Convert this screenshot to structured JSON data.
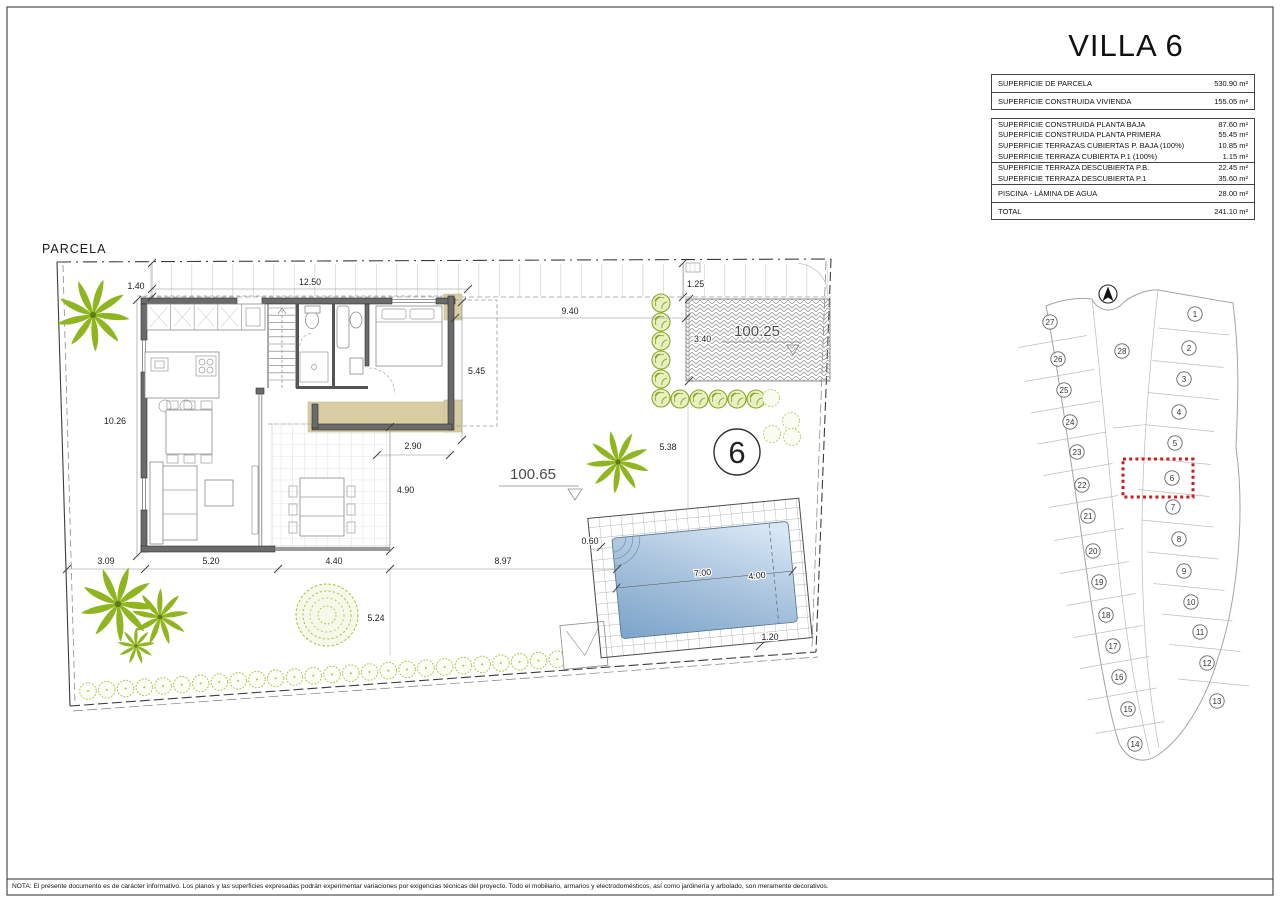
{
  "title": "VILLA 6",
  "areas_table": {
    "sections": [
      {
        "rows": [
          {
            "label": "SUPERFICIE DE PARCELA",
            "value": "530.90 m²"
          }
        ]
      },
      {
        "rows": [
          {
            "label": "SUPERFICIE CONSTRUIDA VIVIENDA",
            "value": "155.05 m²"
          }
        ]
      },
      {
        "rows": [
          {
            "label": "SUPERFICIE CONSTRUIDA PLANTA BAJA",
            "value": "87.60 m²"
          },
          {
            "label": "SUPERFICIE CONSTRUIDA PLANTA PRIMERA",
            "value": "55.45 m²"
          },
          {
            "label": "SUPERFICIE TERRAZAS CUBIERTAS P. BAJA (100%)",
            "value": "10.85 m²"
          },
          {
            "label": "SUPERFICIE TERRAZA CUBIERTA P.1 (100%)",
            "value": "1.15 m²"
          }
        ]
      },
      {
        "rows": [
          {
            "label": "SUPERFICIE TERRAZA DESCUBIERTA P.B.",
            "value": "22.45 m²"
          },
          {
            "label": "SUPERFICIE TERRAZA DESCUBIERTA P.1",
            "value": "35.60 m²"
          }
        ]
      },
      {
        "rows": [
          {
            "label": "PISCINA - LÁMINA DE AGUA",
            "value": "28.00 m²"
          }
        ]
      },
      {
        "rows": [
          {
            "label": "TOTAL",
            "value": "241.10 m²"
          }
        ]
      }
    ]
  },
  "plan": {
    "label": "PARCELA",
    "plot_number": "6",
    "levels": {
      "driveway": "100.25",
      "garden": "100.65"
    },
    "dimensions": {
      "strip_offset": "1.40",
      "strip_width": "12.50",
      "drive_top": "1.25",
      "gap_to_drive": "9.40",
      "drive_height": "3.40",
      "bedroom_depth": "5.45",
      "house_depth": "10.26",
      "porch_width": "2.90",
      "terrace_depth": "4.90",
      "left_setback": "3.09",
      "house_width": "5.20",
      "terrace_width": "4.40",
      "garden_width": "8.97",
      "garden_depth": "5.24",
      "plot_side": "5.38",
      "pool_offset": "0.60",
      "pool_length": "7.00",
      "pool_width": "4.00",
      "pool_edge": "1.20"
    }
  },
  "site_map": {
    "highlighted_plot": "6",
    "plots": [
      "1",
      "2",
      "3",
      "4",
      "5",
      "6",
      "7",
      "8",
      "9",
      "10",
      "11",
      "12",
      "13",
      "14",
      "15",
      "16",
      "17",
      "18",
      "19",
      "20",
      "21",
      "22",
      "23",
      "24",
      "25",
      "26",
      "27",
      "28"
    ]
  },
  "note": "NOTA: El presente documento es de carácter informativo. Los planos y las superficies expresadas podrán experimentar variaciones por exigencias técnicas del proyecto. Todo el mobiliario, armarios y electrodomésticos, así como jardinería y arbolado, son meramente decorativos.",
  "colors": {
    "accent_red": "#c91d1d",
    "palm_green": "#8fb520",
    "hedge_green": "#a9c43e",
    "pool_light": "#d9e7f5",
    "pool_dark": "#7fa6cb",
    "wall_gray": "#6b6b6b",
    "tan": "#d8cda2"
  }
}
